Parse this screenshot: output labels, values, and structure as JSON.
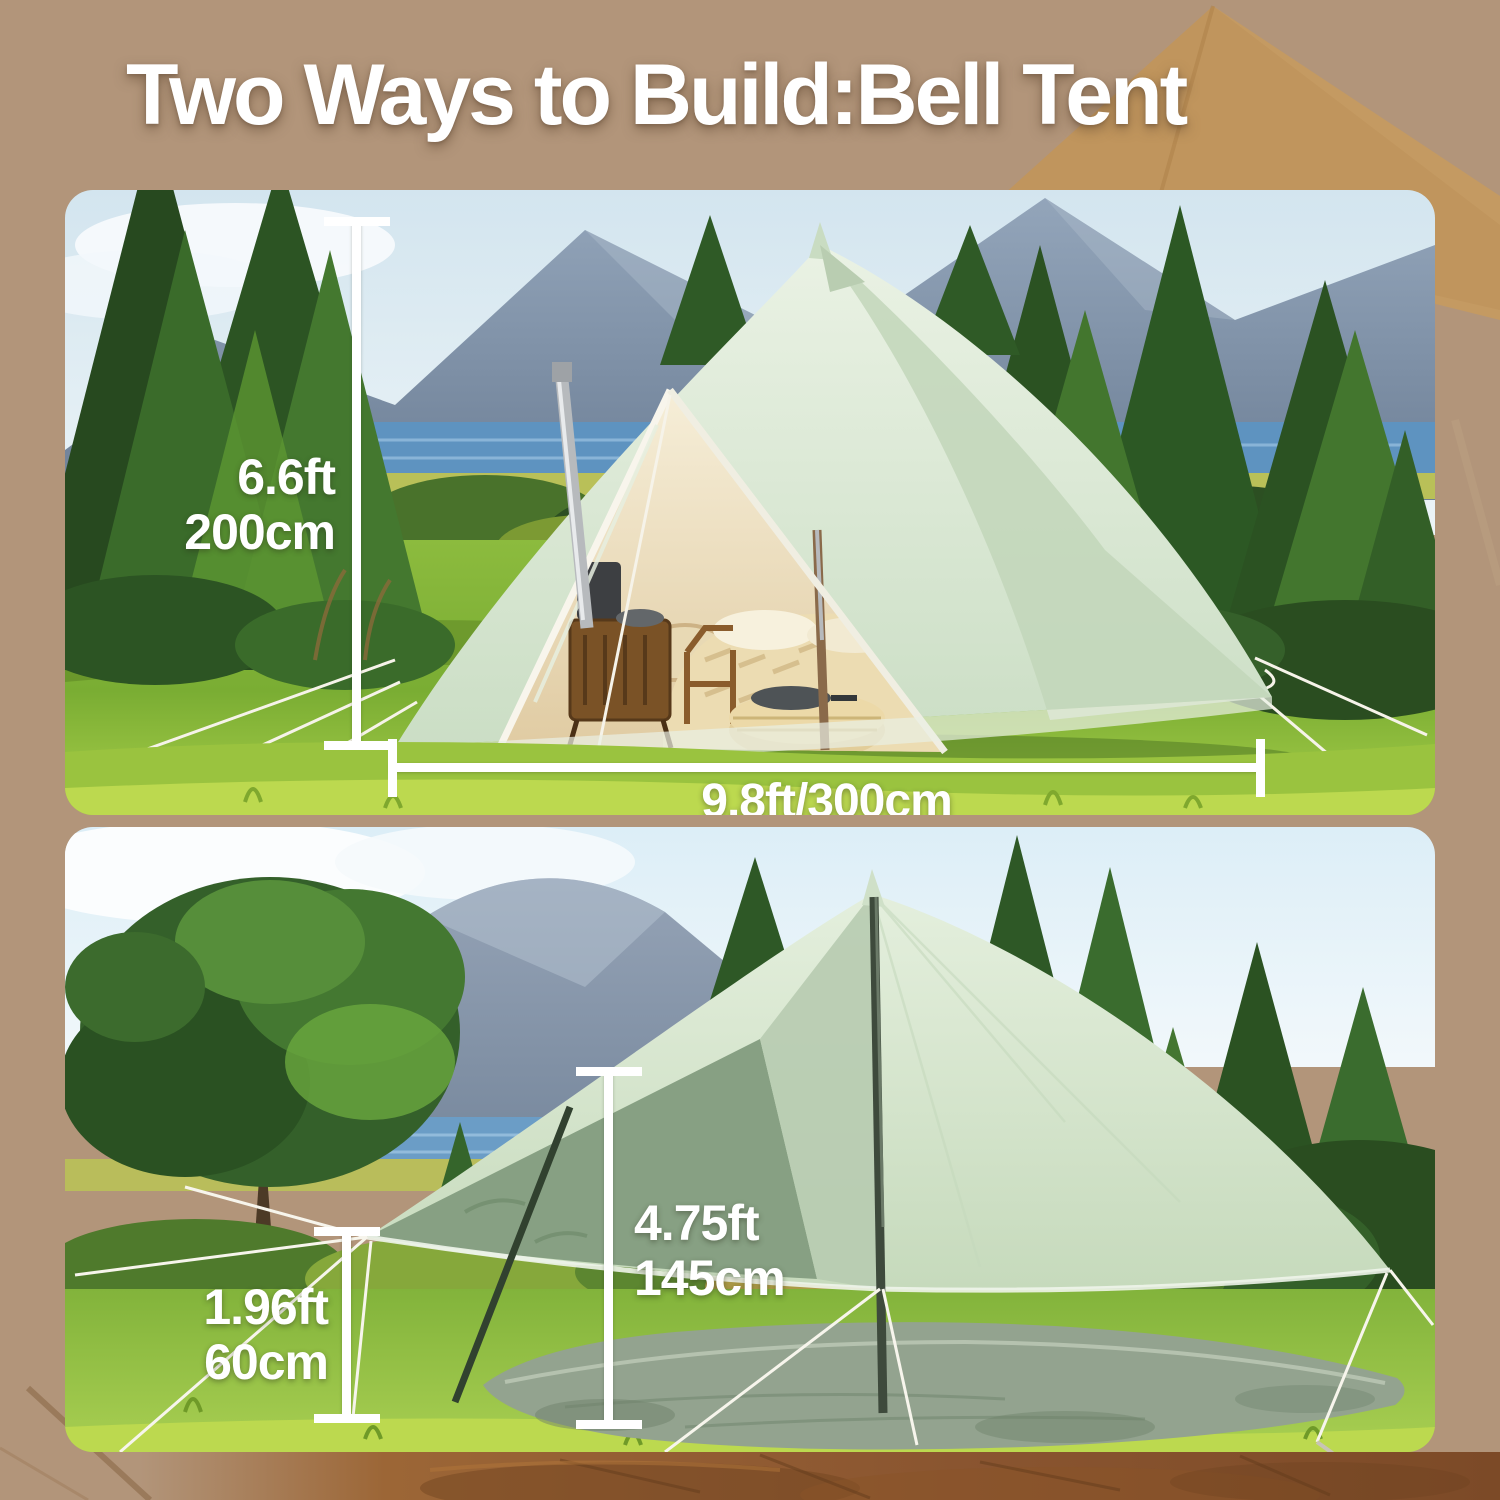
{
  "title": "Two Ways to Build:Bell Tent",
  "colors": {
    "background": "#b2957a",
    "title_text": "#ffffff",
    "annotation_text": "#ffffff",
    "tent_fabric": "#d9e7d3",
    "bg_tent_silhouette": "#c49a62",
    "bottom_ground_band": "#8a5733"
  },
  "photos": {
    "top": {
      "scene": "Bell tent fully pitched at a lakeside forest campsite, door open showing bed and wood stove",
      "height_ft": "6.6ft",
      "height_cm": "200cm",
      "diameter_label": "9.8ft/300cm"
    },
    "bottom": {
      "scene": "Tent fly pitched as an open canopy over its round groundsheet in a meadow",
      "center_height_ft": "4.75ft",
      "center_height_cm": "145cm",
      "edge_height_ft": "1.96ft",
      "edge_height_cm": "60cm"
    }
  }
}
